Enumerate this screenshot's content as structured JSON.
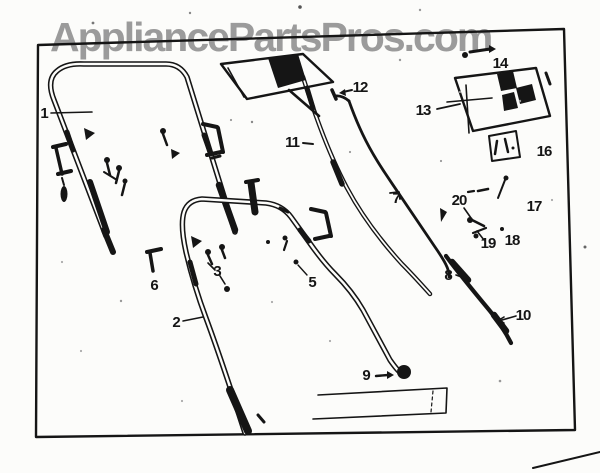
{
  "watermark": {
    "text": "AppliancePartsPros.com",
    "color": "#9b9b9b"
  },
  "diagram": {
    "type": "scanned-parts-diagram",
    "subject": "Lawn mower handle assembly exploded view (upper handle, lower handle, control cables, brackets and mounting hardware)",
    "ink_color": "#151515",
    "paper_color": "#fcfcfa",
    "callouts": [
      {
        "part": "1",
        "x": 44,
        "y": 114
      },
      {
        "part": "2",
        "x": 176,
        "y": 323
      },
      {
        "part": "3",
        "x": 217,
        "y": 272
      },
      {
        "part": "5",
        "x": 312,
        "y": 283
      },
      {
        "part": "6",
        "x": 154,
        "y": 286
      },
      {
        "part": "7",
        "x": 396,
        "y": 199
      },
      {
        "part": "8",
        "x": 448,
        "y": 276
      },
      {
        "part": "9",
        "x": 366,
        "y": 376
      },
      {
        "part": "10",
        "x": 523,
        "y": 316
      },
      {
        "part": "11",
        "x": 292,
        "y": 143
      },
      {
        "part": "12",
        "x": 360,
        "y": 88
      },
      {
        "part": "13",
        "x": 423,
        "y": 111
      },
      {
        "part": "14",
        "x": 500,
        "y": 64
      },
      {
        "part": "16",
        "x": 544,
        "y": 152
      },
      {
        "part": "17",
        "x": 534,
        "y": 207
      },
      {
        "part": "18",
        "x": 512,
        "y": 241
      },
      {
        "part": "19",
        "x": 488,
        "y": 244
      },
      {
        "part": "20",
        "x": 459,
        "y": 201
      }
    ]
  }
}
